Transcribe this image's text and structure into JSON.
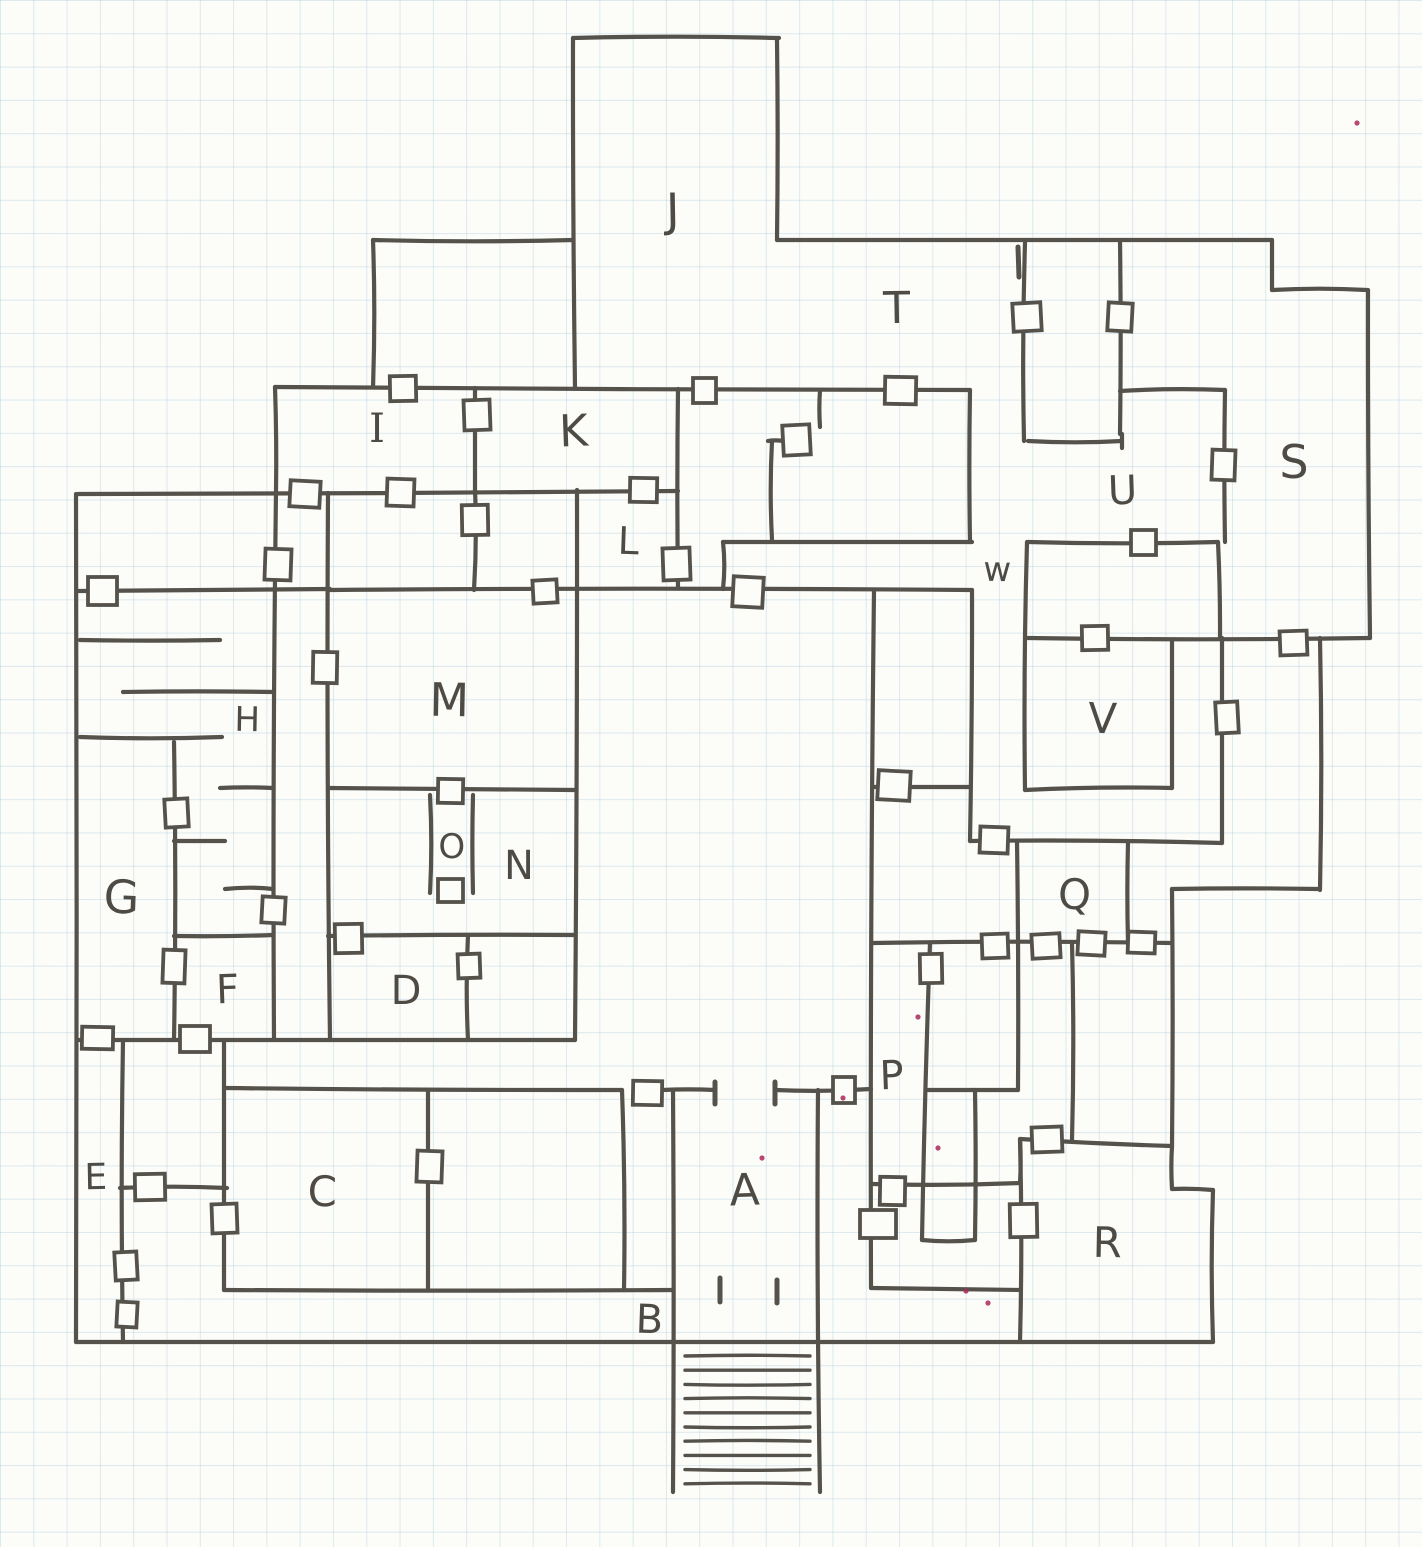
{
  "page": {
    "background": "#fcfcf9",
    "grid_color": "rgba(147,190,214,0.30)",
    "grid_size_px": 33.3,
    "ink_color": "#55524b",
    "label_color": "#4e4b45",
    "speck_color": "#a8295a",
    "door_fill": "#fcfcf9"
  },
  "map": {
    "description": "hand-drawn dungeon floor plan on graph paper",
    "room_labels": [
      {
        "id": "A",
        "text": "A",
        "x": 745,
        "y": 1205,
        "size": 44
      },
      {
        "id": "B",
        "text": "B",
        "x": 649,
        "y": 1333,
        "size": 40
      },
      {
        "id": "C",
        "text": "C",
        "x": 322,
        "y": 1206,
        "size": 42
      },
      {
        "id": "D",
        "text": "D",
        "x": 406,
        "y": 1004,
        "size": 40
      },
      {
        "id": "E",
        "text": "E",
        "x": 96,
        "y": 1189,
        "size": 36
      },
      {
        "id": "F",
        "text": "F",
        "x": 228,
        "y": 1003,
        "size": 40
      },
      {
        "id": "G",
        "text": "G",
        "x": 121,
        "y": 913,
        "size": 46
      },
      {
        "id": "H",
        "text": "H",
        "x": 247,
        "y": 731,
        "size": 34
      },
      {
        "id": "I",
        "text": "I",
        "x": 377,
        "y": 442,
        "size": 40,
        "serif": true
      },
      {
        "id": "J",
        "text": "J",
        "x": 673,
        "y": 226,
        "size": 46
      },
      {
        "id": "K",
        "text": "K",
        "x": 574,
        "y": 446,
        "size": 44
      },
      {
        "id": "L",
        "text": "L",
        "x": 628,
        "y": 554,
        "size": 38
      },
      {
        "id": "M",
        "text": "M",
        "x": 449,
        "y": 716,
        "size": 46
      },
      {
        "id": "N",
        "text": "N",
        "x": 519,
        "y": 879,
        "size": 40
      },
      {
        "id": "O",
        "text": "O",
        "x": 452,
        "y": 858,
        "size": 34
      },
      {
        "id": "P",
        "text": "P",
        "x": 892,
        "y": 1089,
        "size": 40
      },
      {
        "id": "Q",
        "text": "Q",
        "x": 1074,
        "y": 909,
        "size": 42
      },
      {
        "id": "R",
        "text": "R",
        "x": 1107,
        "y": 1257,
        "size": 42
      },
      {
        "id": "S",
        "text": "S",
        "x": 1294,
        "y": 478,
        "size": 46
      },
      {
        "id": "T",
        "text": "T",
        "x": 897,
        "y": 323,
        "size": 44
      },
      {
        "id": "U",
        "text": "U",
        "x": 1123,
        "y": 504,
        "size": 40
      },
      {
        "id": "V",
        "text": "V",
        "x": 1102,
        "y": 733,
        "size": 42
      },
      {
        "id": "W",
        "text": "w",
        "x": 997,
        "y": 581,
        "size": 34
      }
    ],
    "walls": [
      [
        573,
        38,
        779,
        38
      ],
      [
        573,
        38,
        575,
        388
      ],
      [
        777,
        40,
        777,
        240
      ],
      [
        373,
        240,
        573,
        240
      ],
      [
        777,
        240,
        1272,
        240
      ],
      [
        373,
        240,
        373,
        387
      ],
      [
        275,
        387,
        970,
        390
      ],
      [
        275,
        387,
        276,
        492
      ],
      [
        1025,
        243,
        1024,
        441
      ],
      [
        1272,
        240,
        1272,
        290
      ],
      [
        1272,
        290,
        1367,
        290
      ],
      [
        1368,
        290,
        1370,
        638
      ],
      [
        1120,
        240,
        1120,
        434
      ],
      [
        1028,
        441,
        1122,
        441
      ],
      [
        1122,
        434,
        1122,
        448
      ],
      [
        1120,
        391,
        1225,
        390
      ],
      [
        1225,
        390,
        1225,
        542
      ],
      [
        1218,
        542,
        1220,
        638
      ],
      [
        1028,
        638,
        1370,
        638
      ],
      [
        1222,
        638,
        1222,
        843
      ],
      [
        1320,
        638,
        1320,
        890
      ],
      [
        1318,
        889,
        1172,
        889
      ],
      [
        1172,
        889,
        1172,
        1146
      ],
      [
        1028,
        542,
        1218,
        542
      ],
      [
        723,
        542,
        972,
        542
      ],
      [
        723,
        542,
        723,
        589
      ],
      [
        78,
        494,
        678,
        491
      ],
      [
        76,
        494,
        76,
        1342
      ],
      [
        276,
        492,
        274,
        1040
      ],
      [
        78,
        591,
        330,
        589
      ],
      [
        330,
        590,
        972,
        590
      ],
      [
        970,
        390,
        970,
        542
      ],
      [
        972,
        590,
        970,
        841
      ],
      [
        874,
        591,
        871,
        1288
      ],
      [
        873,
        787,
        970,
        787
      ],
      [
        970,
        841,
        1222,
        843
      ],
      [
        1128,
        843,
        1128,
        943
      ],
      [
        1017,
        841,
        1018,
        1090
      ],
      [
        1027,
        542,
        1025,
        790
      ],
      [
        1172,
        640,
        1172,
        788
      ],
      [
        1025,
        790,
        1172,
        788
      ],
      [
        820,
        390,
        820,
        427
      ],
      [
        768,
        441,
        783,
        441
      ],
      [
        772,
        441,
        772,
        540
      ],
      [
        475,
        388,
        475,
        490
      ],
      [
        475,
        490,
        474,
        590
      ],
      [
        678,
        389,
        678,
        588
      ],
      [
        577,
        490,
        575,
        1040
      ],
      [
        328,
        493,
        330,
        1040
      ],
      [
        328,
        788,
        575,
        790
      ],
      [
        430,
        795,
        430,
        893
      ],
      [
        473,
        795,
        473,
        893
      ],
      [
        328,
        936,
        575,
        935
      ],
      [
        468,
        935,
        468,
        1040
      ],
      [
        78,
        1040,
        575,
        1040
      ],
      [
        174,
        742,
        174,
        1040
      ],
      [
        80,
        640,
        220,
        640
      ],
      [
        123,
        692,
        273,
        692
      ],
      [
        80,
        737,
        222,
        737
      ],
      [
        174,
        841,
        225,
        841
      ],
      [
        225,
        889,
        273,
        889
      ],
      [
        174,
        936,
        273,
        935
      ],
      [
        220,
        788,
        273,
        788
      ],
      [
        123,
        1040,
        123,
        1342
      ],
      [
        224,
        1040,
        224,
        1290
      ],
      [
        120,
        1188,
        227,
        1188
      ],
      [
        224,
        1088,
        622,
        1090
      ],
      [
        662,
        1090,
        715,
        1090
      ],
      [
        775,
        1090,
        871,
        1089
      ],
      [
        428,
        1090,
        428,
        1290
      ],
      [
        622,
        1090,
        624,
        1290
      ],
      [
        224,
        1290,
        673,
        1290
      ],
      [
        673,
        1090,
        673,
        1492
      ],
      [
        818,
        1090,
        820,
        1492
      ],
      [
        76,
        1342,
        1213,
        1342
      ],
      [
        873,
        943,
        1172,
        943
      ],
      [
        930,
        943,
        922,
        1240
      ],
      [
        975,
        1090,
        975,
        1240
      ],
      [
        922,
        1240,
        975,
        1240
      ],
      [
        928,
        1090,
        1018,
        1090
      ],
      [
        1072,
        943,
        1072,
        1140
      ],
      [
        1020,
        1139,
        1172,
        1146
      ],
      [
        1020,
        1139,
        1020,
        1183
      ],
      [
        873,
        1184,
        1020,
        1183
      ],
      [
        871,
        1288,
        1020,
        1290
      ],
      [
        1020,
        1140,
        1020,
        1342
      ],
      [
        1172,
        1146,
        1172,
        1189
      ],
      [
        1172,
        1189,
        1213,
        1190
      ],
      [
        1213,
        1190,
        1213,
        1342
      ]
    ],
    "doors": [
      [
        1013,
        303,
        28,
        28
      ],
      [
        1108,
        303,
        24,
        28
      ],
      [
        1212,
        450,
        23,
        30
      ],
      [
        885,
        377,
        31,
        27
      ],
      [
        693,
        378,
        23,
        25
      ],
      [
        390,
        376,
        26,
        25
      ],
      [
        464,
        400,
        26,
        30
      ],
      [
        783,
        425,
        27,
        30
      ],
      [
        290,
        481,
        30,
        26
      ],
      [
        387,
        479,
        27,
        27
      ],
      [
        630,
        478,
        27,
        24
      ],
      [
        88,
        577,
        29,
        28
      ],
      [
        462,
        505,
        26,
        30
      ],
      [
        663,
        548,
        27,
        32
      ],
      [
        533,
        580,
        24,
        23
      ],
      [
        733,
        577,
        30,
        30
      ],
      [
        265,
        549,
        26,
        31
      ],
      [
        313,
        652,
        24,
        31
      ],
      [
        1131,
        530,
        25,
        25
      ],
      [
        1082,
        626,
        26,
        24
      ],
      [
        1280,
        631,
        27,
        24
      ],
      [
        1216,
        702,
        22,
        31
      ],
      [
        878,
        771,
        32,
        29
      ],
      [
        980,
        827,
        28,
        26
      ],
      [
        438,
        779,
        25,
        24
      ],
      [
        438,
        879,
        25,
        23
      ],
      [
        335,
        924,
        27,
        29
      ],
      [
        458,
        954,
        22,
        24
      ],
      [
        165,
        799,
        23,
        28
      ],
      [
        262,
        897,
        23,
        26
      ],
      [
        163,
        950,
        22,
        33
      ],
      [
        82,
        1027,
        31,
        22
      ],
      [
        180,
        1026,
        30,
        26
      ],
      [
        135,
        1174,
        30,
        26
      ],
      [
        212,
        1204,
        25,
        29
      ],
      [
        115,
        1252,
        22,
        28
      ],
      [
        117,
        1302,
        20,
        25
      ],
      [
        417,
        1151,
        25,
        31
      ],
      [
        633,
        1081,
        29,
        24
      ],
      [
        833,
        1077,
        22,
        26
      ],
      [
        920,
        954,
        22,
        29
      ],
      [
        982,
        934,
        26,
        24
      ],
      [
        1032,
        934,
        28,
        24
      ],
      [
        1078,
        932,
        27,
        23
      ],
      [
        1128,
        932,
        27,
        21
      ],
      [
        880,
        1177,
        25,
        28
      ],
      [
        860,
        1210,
        36,
        28
      ],
      [
        1010,
        1204,
        27,
        33
      ],
      [
        1032,
        1127,
        30,
        25
      ]
    ],
    "jambs": [
      [
        715,
        1082,
        715,
        1104
      ],
      [
        775,
        1082,
        775,
        1104
      ],
      [
        720,
        1278,
        720,
        1302
      ],
      [
        777,
        1280,
        777,
        1303
      ],
      [
        1018,
        247,
        1019,
        277
      ]
    ],
    "stairs": {
      "x1": 685,
      "x2": 810,
      "y_first": 1356,
      "step": 14.2,
      "count": 10
    },
    "specks": [
      [
        762,
        1158
      ],
      [
        843,
        1098
      ],
      [
        918,
        1017
      ],
      [
        938,
        1148
      ],
      [
        966,
        1291
      ],
      [
        988,
        1303
      ],
      [
        1357,
        123
      ]
    ]
  }
}
